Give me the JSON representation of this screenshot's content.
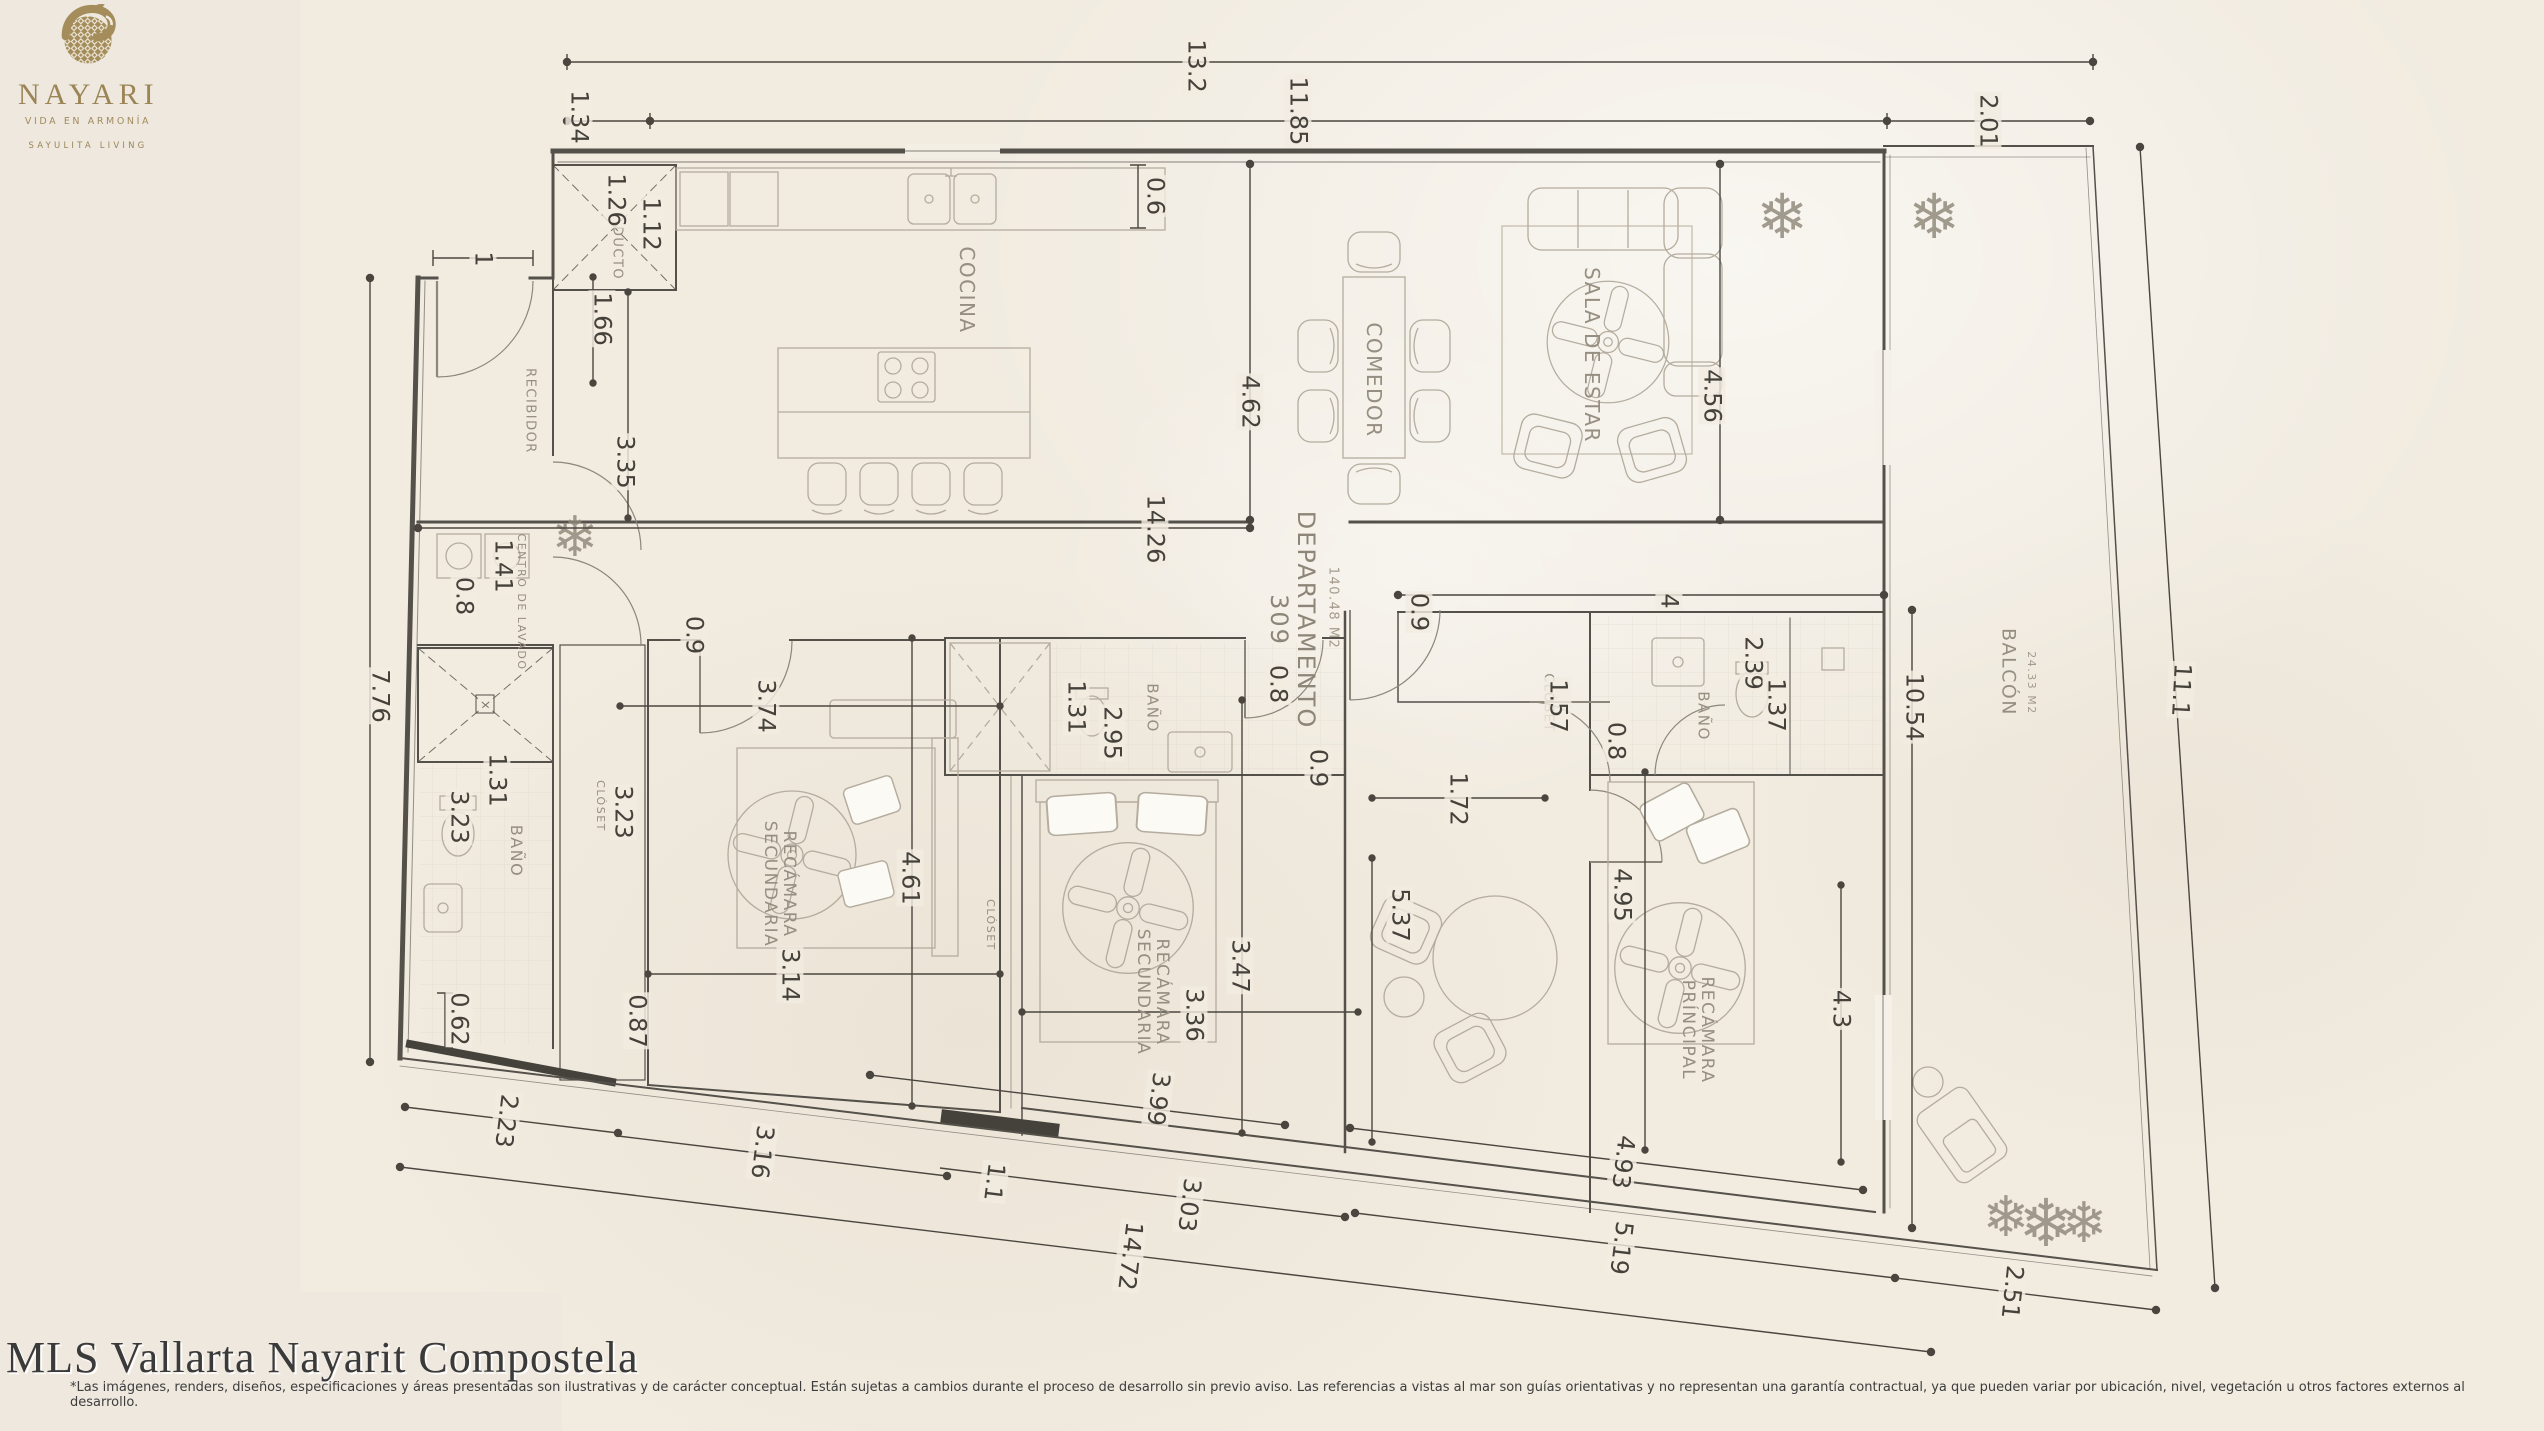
{
  "branding": {
    "logo_name": "NAYARI",
    "logo_tagline": "VIDA EN ARMONÍA",
    "logo_subtagline": "SAYULITA LIVING",
    "gold_color": "#a58d5b"
  },
  "footer": {
    "title": "MLS Vallarta Nayarit Compostela",
    "disclaimer": "*Las imágenes, renders, diseños, especificaciones y áreas presentadas son ilustrativas y de carácter conceptual. Están sujetas a cambios durante el proceso de desarrollo sin previo aviso. Las referencias a vistas al mar son guías orientativas y no representan una garantía contractual, ya que pueden variar por ubicación, nivel, vegetación u otros factores externos al desarrollo."
  },
  "plan": {
    "icons": {
      "plant": "❄"
    },
    "colors": {
      "paper": "#f1ebe0",
      "wall": "#54504a",
      "dimension": "#45413b",
      "furniture": "#b4ac9e",
      "room_label": "#968e80"
    },
    "rooms": [
      {
        "t": "RECIBIDOR",
        "x": 529,
        "y": 411,
        "s": 13
      },
      {
        "t": "DUCTO",
        "x": 616,
        "y": 253,
        "s": 13
      },
      {
        "t": "COCINA",
        "x": 967,
        "y": 290,
        "s": 20
      },
      {
        "t": "COMEDOR",
        "x": 1374,
        "y": 380,
        "s": 20
      },
      {
        "t": "SALA DE ESTAR",
        "x": 1592,
        "y": 355,
        "s": 20
      },
      {
        "t": "CENTRO DE LAVADO",
        "x": 521,
        "y": 602,
        "s": 11
      },
      {
        "t": "BAÑO",
        "x": 516,
        "y": 851,
        "s": 16
      },
      {
        "t": "CLÓSET",
        "x": 600,
        "y": 806,
        "s": 11
      },
      {
        "t": "RECÁMARA\nSECUNDARIA",
        "x": 779,
        "y": 884,
        "s": 17
      },
      {
        "t": "BAÑO",
        "x": 1152,
        "y": 708,
        "s": 15
      },
      {
        "t": "CLÓSET",
        "x": 990,
        "y": 925,
        "s": 11
      },
      {
        "t": "RECÁMARA\nSECUNDARIA",
        "x": 1152,
        "y": 992,
        "s": 17
      },
      {
        "t": "CLÓSET",
        "x": 1547,
        "y": 703,
        "s": 13
      },
      {
        "t": "BAÑO",
        "x": 1703,
        "y": 716,
        "s": 15
      },
      {
        "t": "RECÁMARA\nPRÍNCIPAL",
        "x": 1697,
        "y": 1030,
        "s": 17
      },
      {
        "t": "DEPARTAMENTO\n309",
        "x": 1292,
        "y": 620,
        "s": 24,
        "k": "big"
      },
      {
        "t": "140.48 M2",
        "x": 1332,
        "y": 608,
        "s": 13,
        "k": "sm"
      },
      {
        "t": "BALCÓN",
        "x": 2008,
        "y": 672,
        "s": 19
      },
      {
        "t": "24.33 M2",
        "x": 2031,
        "y": 683,
        "s": 11,
        "k": "sm"
      }
    ],
    "dimensions": [
      {
        "t": "13.2",
        "x": 1196,
        "y": 66
      },
      {
        "t": "1.34",
        "x": 579,
        "y": 117
      },
      {
        "t": "11.85",
        "x": 1298,
        "y": 111
      },
      {
        "t": "2.01",
        "x": 1988,
        "y": 121
      },
      {
        "t": "1.26",
        "x": 616,
        "y": 200
      },
      {
        "t": "1.12",
        "x": 651,
        "y": 224
      },
      {
        "t": "1",
        "x": 483,
        "y": 259
      },
      {
        "t": "1.66",
        "x": 602,
        "y": 319
      },
      {
        "t": "0.6",
        "x": 1155,
        "y": 196
      },
      {
        "t": "3.35",
        "x": 625,
        "y": 462
      },
      {
        "t": "4.62",
        "x": 1250,
        "y": 402
      },
      {
        "t": "4.56",
        "x": 1712,
        "y": 396
      },
      {
        "t": "14.26",
        "x": 1155,
        "y": 529
      },
      {
        "t": "1.41",
        "x": 503,
        "y": 566
      },
      {
        "t": "0.8",
        "x": 464,
        "y": 596
      },
      {
        "t": "0.9",
        "x": 694,
        "y": 635
      },
      {
        "t": "7.76",
        "x": 380,
        "y": 696
      },
      {
        "t": "1.31",
        "x": 497,
        "y": 780
      },
      {
        "t": "3.23",
        "x": 459,
        "y": 817
      },
      {
        "t": "3.23",
        "x": 623,
        "y": 812
      },
      {
        "t": "0.62",
        "x": 459,
        "y": 1019
      },
      {
        "t": "0.87",
        "x": 637,
        "y": 1021
      },
      {
        "t": "3.74",
        "x": 766,
        "y": 706
      },
      {
        "t": "1.31",
        "x": 1076,
        "y": 707
      },
      {
        "t": "2.95",
        "x": 1112,
        "y": 733
      },
      {
        "t": "4.61",
        "x": 910,
        "y": 878
      },
      {
        "t": "3.14",
        "x": 790,
        "y": 975
      },
      {
        "t": "0.9",
        "x": 1419,
        "y": 612
      },
      {
        "t": "4",
        "x": 1669,
        "y": 601
      },
      {
        "t": "1.57",
        "x": 1558,
        "y": 706
      },
      {
        "t": "0.8",
        "x": 1616,
        "y": 741
      },
      {
        "t": "2.39",
        "x": 1753,
        "y": 663
      },
      {
        "t": "1.37",
        "x": 1776,
        "y": 705
      },
      {
        "t": "0.8",
        "x": 1278,
        "y": 684
      },
      {
        "t": "0.9",
        "x": 1318,
        "y": 768
      },
      {
        "t": "1.72",
        "x": 1458,
        "y": 799
      },
      {
        "t": "5.37",
        "x": 1400,
        "y": 915
      },
      {
        "t": "4.95",
        "x": 1622,
        "y": 895
      },
      {
        "t": "10.54",
        "x": 1914,
        "y": 707
      },
      {
        "t": "11.1",
        "x": 2181,
        "y": 690,
        "r": 93
      },
      {
        "t": "3.47",
        "x": 1240,
        "y": 966
      },
      {
        "t": "3.36",
        "x": 1194,
        "y": 1015
      },
      {
        "t": "4.3",
        "x": 1841,
        "y": 1009
      },
      {
        "t": "3.99",
        "x": 1158,
        "y": 1099,
        "r": 97
      },
      {
        "t": "1.1",
        "x": 994,
        "y": 1182,
        "r": 97
      },
      {
        "t": "3.03",
        "x": 1189,
        "y": 1205,
        "r": 97
      },
      {
        "t": "14.72",
        "x": 1130,
        "y": 1256,
        "r": 97
      },
      {
        "t": "2.23",
        "x": 506,
        "y": 1121,
        "r": 97
      },
      {
        "t": "3.16",
        "x": 762,
        "y": 1152,
        "r": 97
      },
      {
        "t": "4.93",
        "x": 1623,
        "y": 1162,
        "r": 97
      },
      {
        "t": "5.19",
        "x": 1621,
        "y": 1248,
        "r": 97
      },
      {
        "t": "2.51",
        "x": 2012,
        "y": 1292,
        "r": 96
      }
    ]
  }
}
